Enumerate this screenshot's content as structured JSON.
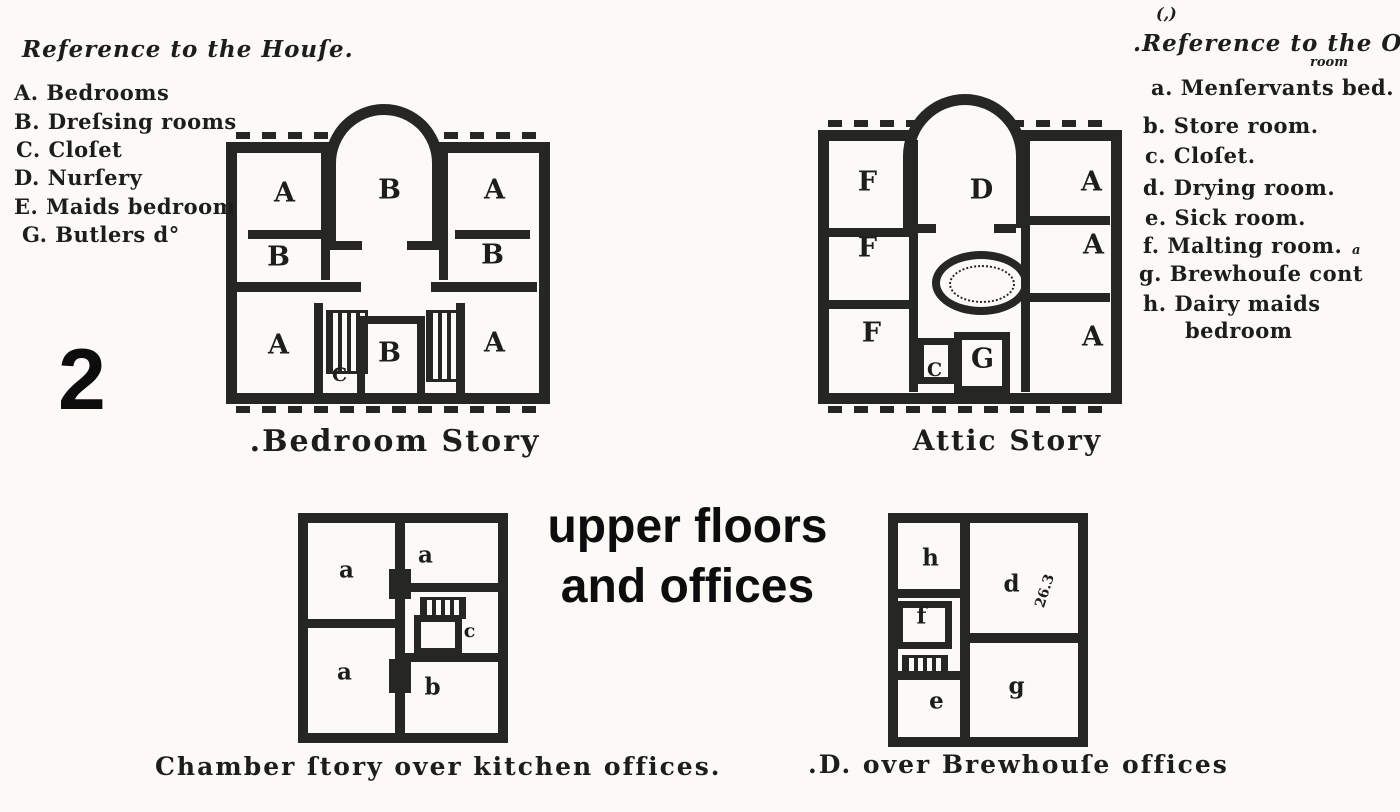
{
  "colors": {
    "ink": "#1d1d1b",
    "wall": "#262624",
    "paper": "#fbfaf7"
  },
  "page_label": "2",
  "overlay": {
    "line1": "upper floors",
    "line2": "and offices"
  },
  "house_legend": {
    "title": "Reference to the Houſe.",
    "items": [
      "A. Bedrooms",
      "B. Dreſsing rooms",
      "C. Cloſet",
      "D. Nurſery",
      "E. Maids bedroom",
      "G. Butlers d°"
    ]
  },
  "offices_legend": {
    "top_mark": "(,)",
    "title": ".Reference to the Offices.",
    "sup_room": "room",
    "sup_a": "a",
    "items": [
      "a. Menſervants bed.",
      "b. Store room.",
      "c. Cloſet.",
      "d. Drying room.",
      "e. Sick room.",
      "f. Malting room.",
      "g. Brewhouſe cont",
      "h. Dairy maids",
      "bedroom"
    ]
  },
  "plans": {
    "bedroom_story": {
      "caption": ".Bedroom Story",
      "rooms": {
        "tl": "A",
        "bow": "B",
        "tr": "A",
        "ml": "B",
        "mr": "B",
        "bl": "A",
        "bc": "B",
        "closet": "C",
        "br": "A"
      }
    },
    "attic_story": {
      "caption": "Attic Story",
      "rooms": {
        "tl": "F",
        "bow": "D",
        "tr": "A",
        "ml": "F",
        "mr": "A",
        "bl": "F",
        "closet": "C",
        "bc": "G",
        "br": "A"
      }
    },
    "chamber_story": {
      "caption": "Chamber ſtory over kitchen offices.",
      "rooms": {
        "tl": "a",
        "tr": "a",
        "closet": "c",
        "bl": "a",
        "br": "b"
      }
    },
    "brewhouse": {
      "caption": ".D. over Brewhouſe offices",
      "rooms": {
        "tl": "h",
        "tr": "d",
        "ml": "f",
        "bl": "e",
        "br": "g"
      },
      "dimension_note": "26.3"
    }
  }
}
